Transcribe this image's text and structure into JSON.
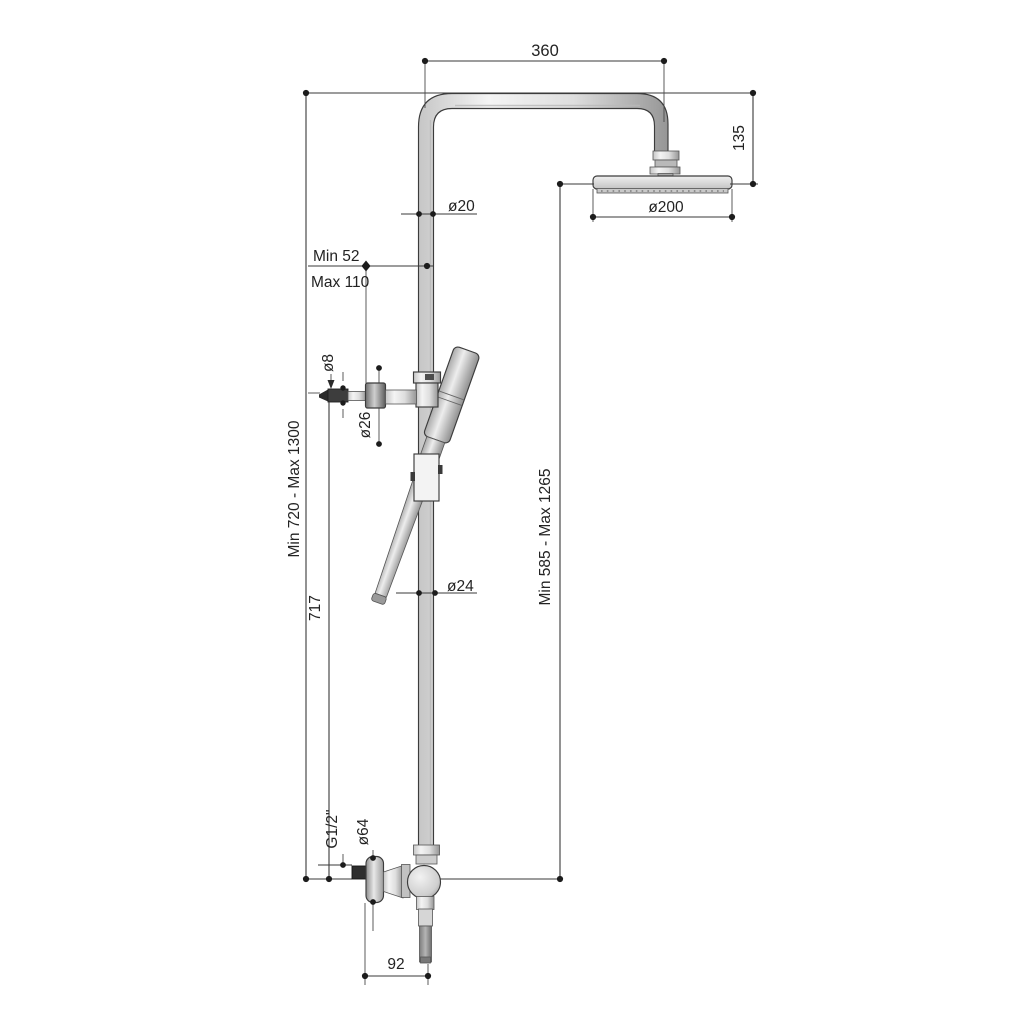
{
  "drawing": {
    "title": "shower-column-technical-drawing",
    "background": "#ffffff",
    "line_color": "#3a3a3a",
    "dimensions": {
      "arm_length": "360",
      "head_drop": "135",
      "riser_diameter_top": "ø20",
      "head_diameter": "ø200",
      "bracket_min": "Min 52",
      "bracket_max": "Max 110",
      "wall_pin_diameter": "ø8",
      "bracket_knob_diameter": "ø26",
      "overall_height_range": "Min 720 - Max 1300",
      "bracket_height": "717",
      "head_height_range": "Min 585 - Max 1265",
      "riser_diameter_bottom": "ø24",
      "inlet_thread": "G1/2\"",
      "flange_diameter": "ø64",
      "outlet_offset": "92"
    }
  }
}
